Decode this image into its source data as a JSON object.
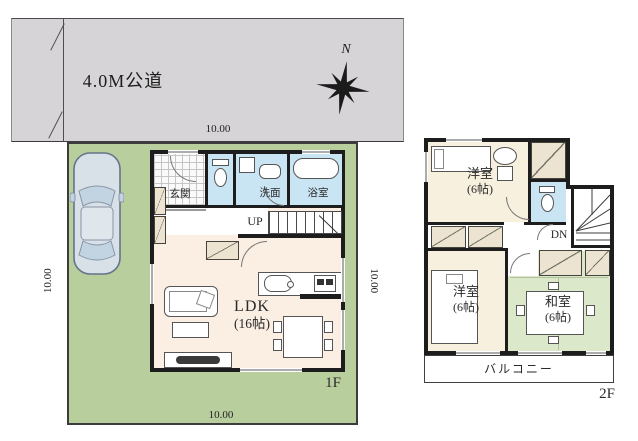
{
  "site": {
    "road_label": "4.0M公道",
    "compass_north": "N",
    "dim_top": "10.00",
    "dim_left": "10.00",
    "dim_right": "10.00",
    "dim_bottom": "10.00"
  },
  "floor1": {
    "floor_label": "1F",
    "entrance": "玄関",
    "washroom": "洗面",
    "bathroom": "浴室",
    "stairs": "UP",
    "ldk_name": "LDK",
    "ldk_size": "(16帖)"
  },
  "floor2": {
    "floor_label": "2F",
    "bedroom_top_name": "洋室",
    "bedroom_top_size": "(6帖)",
    "bedroom_left_name": "洋室",
    "bedroom_left_size": "(6帖)",
    "tatami_name": "和室",
    "tatami_size": "(6帖)",
    "stairs": "DN",
    "balcony": "バルコニー"
  },
  "colors": {
    "road": "#d6d4d6",
    "lot": "#b9ce9d",
    "wet_room": "#c9e4f2",
    "ldk_floor": "#fbeee2",
    "bedroom_floor": "#f7f0de",
    "tatami_floor": "#dce8ca",
    "closet": "#ece4d0",
    "wall": "#1d1d1d"
  },
  "icons": {
    "compass": "8-point star",
    "car": "car top view shape",
    "toilet": "tank + bowl shape",
    "bathtub": "rounded rectangle",
    "sofa": "rounded rectangle with cushion",
    "bed": "rectangle with pillow",
    "stairs": "striped treads"
  }
}
